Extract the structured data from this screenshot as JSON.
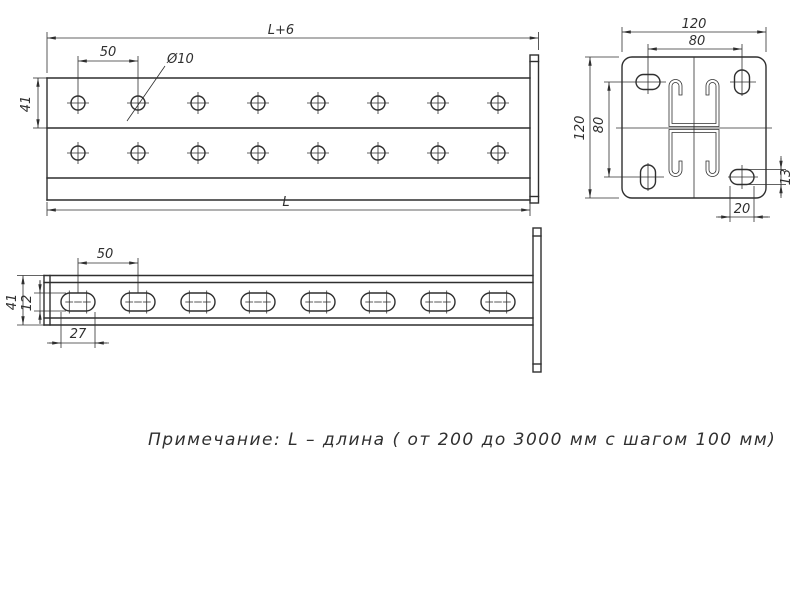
{
  "note": "Примечание: L – длина ( от 200 до 3000 мм с шагом 100 мм)",
  "front_view": {
    "dim_overall_top": "L+6",
    "dim_hole_pitch": "50",
    "dim_hole_diameter": "Ø10",
    "dim_channel_height": "41",
    "dim_overall_bottom": "L"
  },
  "side_view": {
    "dim_slot_pitch": "50",
    "dim_height": "41",
    "dim_slot_height": "12",
    "dim_slot_length": "27"
  },
  "end_view": {
    "dim_plate_width": "120",
    "dim_hole_span_horizontal": "80",
    "dim_plate_height": "120",
    "dim_hole_span_vertical": "80",
    "dim_slot_minor": "13",
    "dim_slot_major": "20"
  },
  "colors": {
    "line": "#2f2f2f",
    "background": "#ffffff"
  }
}
